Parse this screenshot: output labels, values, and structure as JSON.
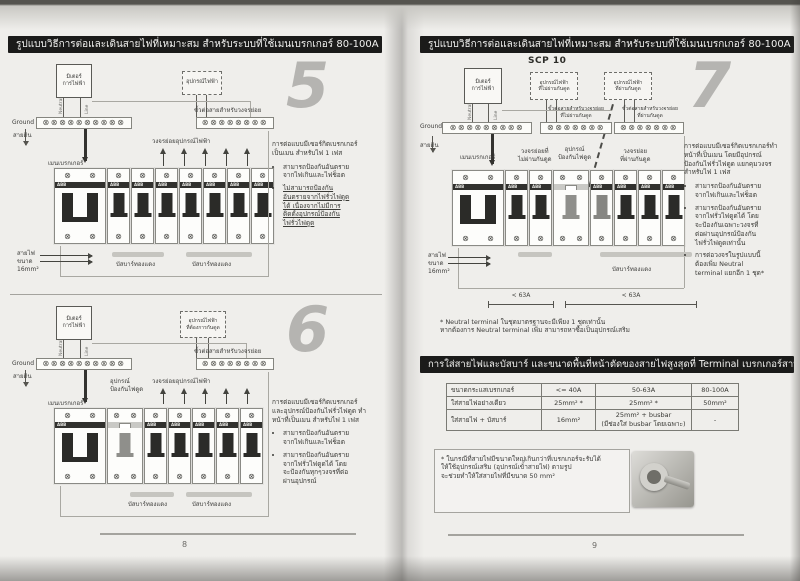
{
  "glyphs": {
    "screw": "⊗"
  },
  "abb": "ABB",
  "colors": {
    "header_bg": "#1b1b1a",
    "numeral_gray": "#b5b4b1",
    "toggle_dark": "#2b2b28"
  },
  "strips": {
    "l5g": 10,
    "l5b": 8,
    "l6g": 10,
    "l6b": 8,
    "r7g": 9,
    "r7m": 7,
    "r7r": 7
  },
  "panels": {
    "p5": [
      "main",
      "b",
      "b",
      "b",
      "b",
      "b",
      "b",
      "b"
    ],
    "p6": [
      "main",
      "rcd",
      "b",
      "b",
      "b",
      "b",
      "b"
    ],
    "p7": [
      "main",
      "b",
      "b",
      "rcd",
      "bl",
      "b",
      "b",
      "b"
    ]
  },
  "left_page": {
    "header": "รูปแบบวิธีการต่อและเดินสายไฟที่เหมาะสม สำหรับระบบที่ใช้เมนเบรกเกอร์ 80-100A",
    "page_number": "8",
    "d5": {
      "number": "5",
      "meter": "มิเตอร์\nการไฟฟ้า",
      "neutral": "Neutral",
      "line": "Line",
      "ground": "Ground",
      "earth": "สายดิน",
      "equip_box": "อุปกรณ์ไฟฟ้า",
      "branch_terminal": "ขั้วต่อสายสำหรับวงจรย่อย",
      "main_breaker": "เมนเบรกเกอร์",
      "branch_circuits": "วงจรย่อยอุปกรณ์ไฟฟ้า",
      "wire_size": "สายไฟ\nขนาด\n16mm²",
      "busbar1": "บัสบาร์ทองแดง",
      "busbar2": "บัสบาร์ทองแดง",
      "desc_title": "การต่อแบบมีเซอร์กิตเบรกเกอร์\nเป็นเมน สำหรับไฟ 1 เฟส",
      "bullets": [
        "สามารถป้องกันอันตราย\nจากไฟเกินและไฟช็อต",
        "ไม่สามารถป้องกัน\nอันตรายจากไฟรั่วไฟดูด\nได้ เนื่องจากไม่มีการ\nติดตั้งอุปกรณ์ป้องกัน\nไฟรั่วไฟดูด"
      ]
    },
    "d6": {
      "number": "6",
      "meter": "มิเตอร์\nการไฟฟ้า",
      "neutral": "Neutral",
      "line": "Line",
      "ground": "Ground",
      "earth": "สายดิน",
      "equip_box": "อุปกรณ์ไฟฟ้า\nที่ต้องการกันดูด",
      "branch_terminal": "ขั้วต่อสายสำหรับวงจรย่อย",
      "main_breaker": "เมนเบรกเกอร์",
      "rcd_label": "อุปกรณ์\nป้องกันไฟดูด",
      "branch_circuits": "วงจรย่อยอุปกรณ์ไฟฟ้า",
      "busbar1": "บัสบาร์ทองแดง",
      "busbar2": "บัสบาร์ทองแดง",
      "desc_title": "การต่อแบบมีเซอร์กิตเบรกเกอร์\nและอุปกรณ์ป้องกันไฟรั่วไฟดูด ทำ\nหน้าที่เป็นเมน สำหรับไฟ 1 เฟส",
      "bullets": [
        "สามารถป้องกันอันตราย\nจากไฟเกินและไฟช็อต",
        "สามารถป้องกันอันตราย\nจากไฟรั่วไฟดูดได้ โดย\nจะป้องกันทุกๆวงจรที่ต่อ\nผ่านอุปกรณ์"
      ]
    }
  },
  "right_page": {
    "header": "รูปแบบวิธีการต่อและเดินสายไฟที่เหมาะสม สำหรับระบบที่ใช้เมนเบรกเกอร์ 80-100A",
    "page_number": "9",
    "scp": "SCP 10",
    "d7": {
      "number": "7",
      "meter": "มิเตอร์\nการไฟฟ้า",
      "neutral": "Neutral",
      "line": "Line",
      "ground": "Ground",
      "earth": "สายดิน",
      "equip_box1": "อุปกรณ์ไฟฟ้า\nที่ไม่ผ่านกันดูด",
      "equip_box2": "อุปกรณ์ไฟฟ้า\nที่ผ่านกันดูด",
      "terminal1": "ขั้วต่อสายสำหรับวงจรย่อย\nที่ไม่ผ่านกันดูด",
      "terminal2": "ขั้วต่อสายสำหรับวงจรย่อย\nที่ผ่านกันดูด",
      "main_breaker": "เมนเบรกเกอร์",
      "branch_no_rcd": "วงจรย่อยที่\nไม่ผ่านกันดูด",
      "rcd_label": "อุปกรณ์\nป้องกันไฟดูด",
      "branch_rcd": "วงจรย่อย\nที่ผ่านกันดูด",
      "wire_size": "สายไฟ\nขนาด\n16mm²",
      "busbar": "บัสบาร์ทองแดง",
      "dim1": "< 63A",
      "dim2": "< 63A",
      "desc_title": "การต่อแบบมีเซอร์กิตเบรกเกอร์ทำ\nหน้าที่เป็นเมน โดยมีอุปกรณ์\nป้องกันไฟรั่วไฟดูด แยกคุมวงจร\nสำหรับไฟ 1 เฟส",
      "bullets": [
        "สามารถป้องกันอันตราย\nจากไฟเกินและไฟช็อต",
        "สามารถป้องกันอันตราย\nจากไฟรั่วไฟดูดได้ โดย\nจะป้องกันเฉพาะวงจรที่\nต่อผ่านอุปกรณ์ป้องกัน\nไฟรั่วไฟดูดเท่านั้น",
        "การต่อวงจรในรูปแบบนี้\nต้องเพิ่ม Neutral\nterminal แยกอีก 1 ชุด*"
      ]
    },
    "note": "* Neutral terminal ในชุดมาตรฐานจะมีเพียง 1 ชุดเท่านั้น\nหากต้องการ Neutral terminal เพิ่ม สามารถหาซื้อเป็นอุปกรณ์เสริม",
    "table_header": "การใส่สายไฟและบัสบาร์ และขนาดพื้นที่หน้าตัดของสายไฟสูงสุดที่ Terminal เบรกเกอร์สามารถรับได้",
    "table": {
      "col_headers": [
        "ขนาดกระแสเบรกเกอร์",
        "<= 40A",
        "50-63A",
        "80-100A"
      ],
      "rows": [
        {
          "label": "ใส่สายไฟอย่างเดียว",
          "c1": "25mm² *",
          "c2": "25mm² *",
          "c3": "50mm²"
        },
        {
          "label": "ใส่สายไฟ + บัสบาร์",
          "c1": "16mm²",
          "c2": "25mm² + busbar\n(มีช่องใส่ busbar โดยเฉพาะ)",
          "c3": "-"
        }
      ]
    },
    "footnote": "* ในกรณีที่สายไฟมีขนาดใหญ่เกินกว่าที่เบรกเกอร์จะรับได้\nให้ใช้อุปกรณ์เสริม (อุปกรณ์เข้าสายไฟ) ตามรูป\nจะช่วยทำให้ใส่สายไฟที่มีขนาด 50 mm²"
  }
}
